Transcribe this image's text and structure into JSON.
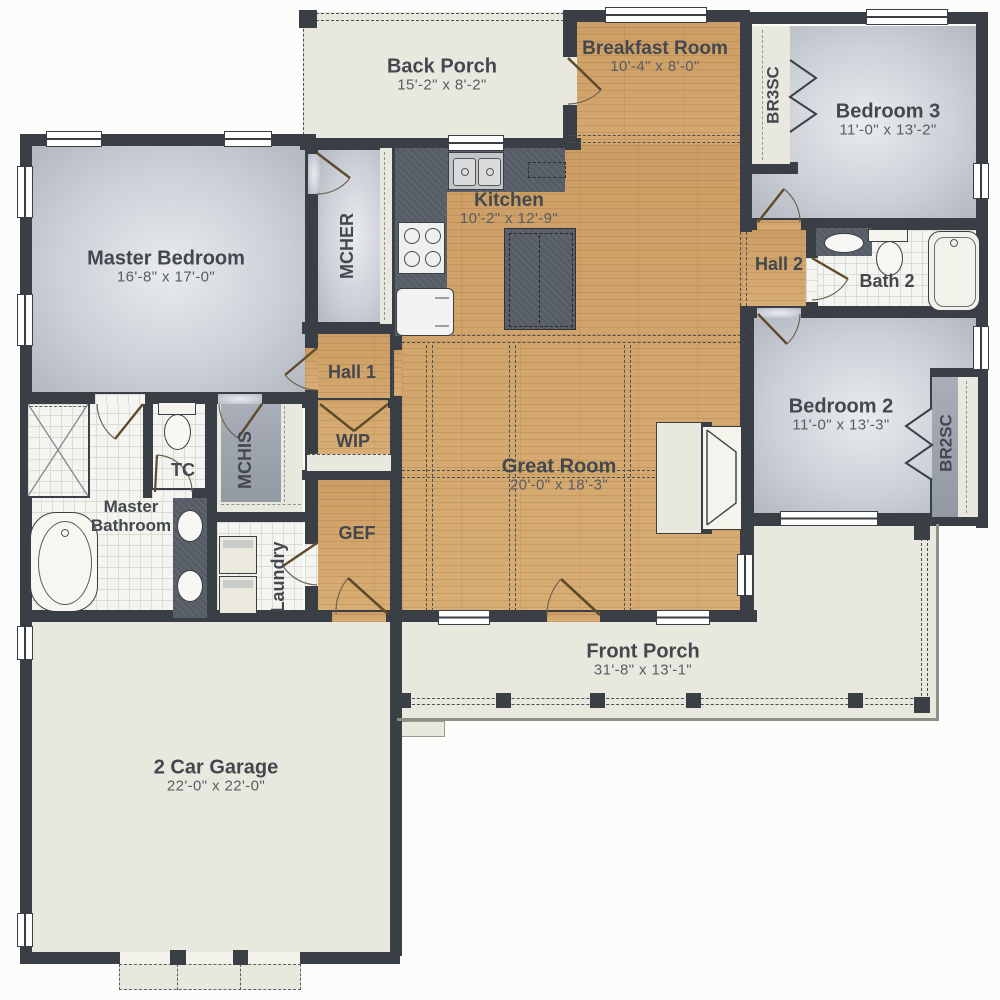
{
  "colors": {
    "wood_floor": "#d2a56c",
    "gray_room": "#c3c8cf",
    "cream_area": "#e9e8df",
    "wall": "#3a3f46",
    "counter": "#565c66",
    "label_text": "#43484e"
  },
  "rooms": {
    "back_porch": {
      "name": "Back Porch",
      "dims": "15'-2\" x 8'-2\""
    },
    "breakfast_room": {
      "name": "Breakfast Room",
      "dims": "10'-4\" x 8'-0\""
    },
    "bedroom3": {
      "name": "Bedroom 3",
      "dims": "11'-0\" x 13'-2\""
    },
    "master_bedroom": {
      "name": "Master Bedroom",
      "dims": "16'-8\" x 17'-0\""
    },
    "kitchen": {
      "name": "Kitchen",
      "dims": "10'-2\" x 12'-9\""
    },
    "hall2": {
      "name": "Hall 2"
    },
    "bath2": {
      "name": "Bath 2"
    },
    "bedroom2": {
      "name": "Bedroom 2",
      "dims": "11'-0\" x 13'-3\""
    },
    "great_room": {
      "name": "Great Room",
      "dims": "20'-0\" x 18'-3\""
    },
    "hall1": {
      "name": "Hall 1"
    },
    "wip": {
      "name": "WIP"
    },
    "gef": {
      "name": "GEF"
    },
    "tc": {
      "name": "TC"
    },
    "master_bathroom": {
      "name": "Master Bathroom"
    },
    "laundry": {
      "name": "Laundry"
    },
    "front_porch": {
      "name": "Front Porch",
      "dims": "31'-8\" x 13'-1\""
    },
    "garage": {
      "name": "2 Car Garage",
      "dims": "22'-0\" x 22'-0\""
    },
    "mcher": {
      "name": "MCHER"
    },
    "mchis": {
      "name": "MCHIS"
    },
    "br3sc": {
      "name": "BR3SC"
    },
    "br2sc": {
      "name": "BR2SC"
    }
  }
}
